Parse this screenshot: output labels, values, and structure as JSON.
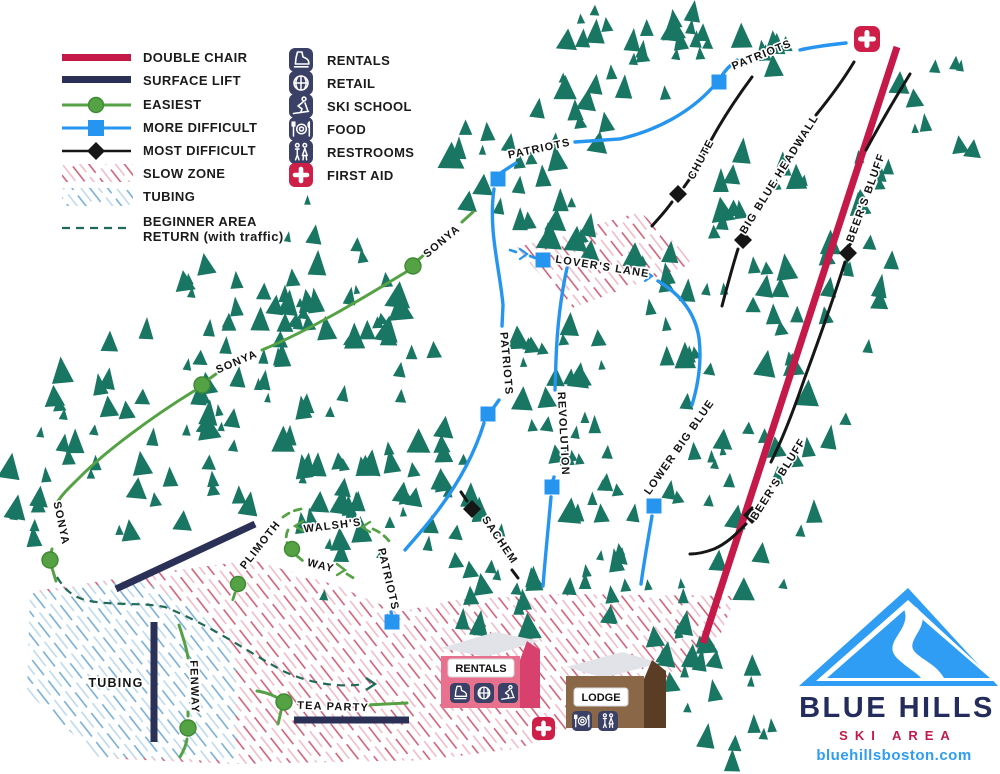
{
  "legend": {
    "items": [
      {
        "label": "DOUBLE CHAIR"
      },
      {
        "label": "SURFACE LIFT"
      },
      {
        "label": "EASIEST"
      },
      {
        "label": "MORE DIFFICULT"
      },
      {
        "label": "MOST DIFFICULT"
      },
      {
        "label": "SLOW ZONE"
      },
      {
        "label": "TUBING"
      },
      {
        "label": "BEGINNER AREA",
        "label2": "RETURN (with traffic)"
      }
    ]
  },
  "services": {
    "items": [
      {
        "label": "RENTALS",
        "icon": "ski-boot-icon"
      },
      {
        "label": "RETAIL",
        "icon": "retail-icon"
      },
      {
        "label": "SKI SCHOOL",
        "icon": "ski-school-icon"
      },
      {
        "label": "FOOD",
        "icon": "food-icon"
      },
      {
        "label": "RESTROOMS",
        "icon": "restrooms-icon"
      },
      {
        "label": "FIRST AID",
        "icon": "first-aid-icon"
      }
    ]
  },
  "trails": {
    "patriots": {
      "name": "PATRIOTS",
      "difficulty": "more-difficult"
    },
    "sonya": {
      "name": "SONYA",
      "difficulty": "easiest"
    },
    "chute": {
      "name": "CHUTE",
      "difficulty": "most-difficult"
    },
    "big_blue_headwall": {
      "name": "BIG BLUE HEADWALL",
      "difficulty": "most-difficult"
    },
    "beers_bluff": {
      "name": "BEER'S BLUFF",
      "difficulty": "most-difficult"
    },
    "lovers_lane": {
      "name": "LOVER'S LANE",
      "difficulty": "more-difficult"
    },
    "revolution": {
      "name": "REVOLUTION",
      "difficulty": "more-difficult"
    },
    "lower_big_blue": {
      "name": "LOWER BIG BLUE",
      "difficulty": "more-difficult"
    },
    "sachem": {
      "name": "SACHEM",
      "difficulty": "most-difficult"
    },
    "walshs_way": {
      "line1": "WALSH'S",
      "line2": "WAY",
      "difficulty": "easiest"
    },
    "plimoth": {
      "name": "PLIMOTH",
      "difficulty": "easiest"
    },
    "fenway": {
      "name": "FENWAY",
      "difficulty": "easiest"
    },
    "tea_party": {
      "name": "TEA PARTY",
      "difficulty": "easiest"
    }
  },
  "areas": {
    "tubing": "TUBING"
  },
  "buildings": {
    "rentals": {
      "label": "RENTALS",
      "icons": [
        "ski-boot-icon",
        "retail-icon",
        "ski-school-icon"
      ]
    },
    "lodge": {
      "label": "LODGE",
      "icons": [
        "food-icon",
        "restrooms-icon"
      ]
    }
  },
  "logo": {
    "title": "BLUE HILLS",
    "subtitle": "SKI AREA",
    "website": "bluehillsboston.com"
  },
  "colors": {
    "tree": "#187663",
    "double_chair": "#c41949",
    "surface_lift": "#2b3156",
    "easiest": "#55a245",
    "more_difficult": "#2595f0",
    "most_difficult": "#161616",
    "beginner_return": "#226a58",
    "slow_zone_hatch": "#d4566f",
    "tubing_hatch": "#7fb3d9",
    "first_aid": "#ce1f48",
    "icon_tile": "#3b4066",
    "logo_navy": "#232c5c",
    "logo_blue": "#2e9df3"
  }
}
